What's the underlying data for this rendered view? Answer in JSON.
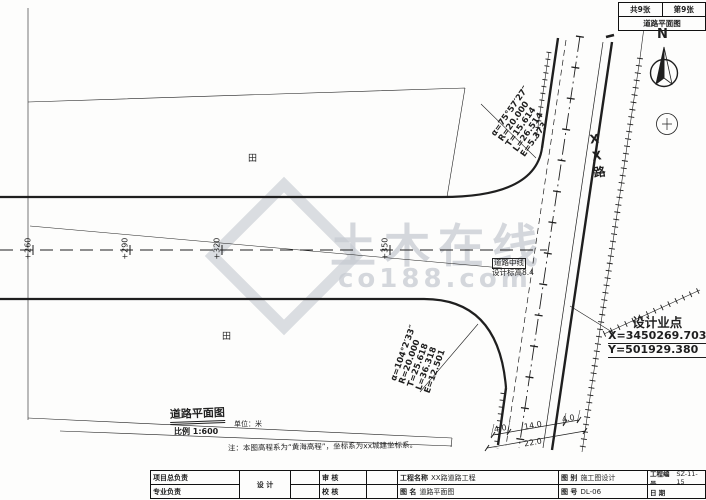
{
  "sheet_header": {
    "total": "共9张",
    "number": "第9张",
    "title": "道路平面图"
  },
  "compass": {
    "label": "N"
  },
  "road": {
    "name": "XX路"
  },
  "curve_top": {
    "a": "α=75°57′27″",
    "r": "R=20.000",
    "t": "T=15.614",
    "l": "L=26.514",
    "e": "E=5.373"
  },
  "curve_bottom": {
    "a": "α=104°2′33″",
    "r": "R=20.000",
    "t": "T=25.618",
    "l": "L=36.318",
    "e": "E=12.501"
  },
  "design_point": {
    "title": "设计业点",
    "x": "X=3450269.703",
    "y": "Y=501929.380"
  },
  "stations": [
    "+260",
    "+290",
    "+320",
    "+350"
  ],
  "centerline_label": {
    "line1": "道路中线",
    "line2": "设计标高8.4"
  },
  "plan_caption": {
    "title": "道路平面图",
    "unit": "单位：米",
    "scale": "比例 1:600"
  },
  "note": "注：本图高程系为“黄海高程”，坐标系为xx城建坐标系。",
  "dimensions": {
    "d1": "4.0",
    "d2": "14.0",
    "d3": "4.0",
    "total": "22.0"
  },
  "land": {
    "upper": "田",
    "lower": "田"
  },
  "watermark": {
    "line1": "土木在线",
    "line2": "co188.com"
  },
  "title_block": {
    "pm": "项目总负责",
    "pro": "专业负责",
    "design": "设 计",
    "review": "审 核",
    "check": "校 核",
    "project_label": "工程名称",
    "project": "XX路道路工程",
    "name_label": "图 名",
    "name": "道路平面图",
    "cat_label": "图 别",
    "cat": "施工图设计",
    "no_label": "图 号",
    "no": "DL-06",
    "code_label": "工程编号",
    "code": "SZ-11-15",
    "date_label": "日 期"
  },
  "colors": {
    "ink": "#1f1f1f",
    "watermark": "#c7cbd2"
  }
}
